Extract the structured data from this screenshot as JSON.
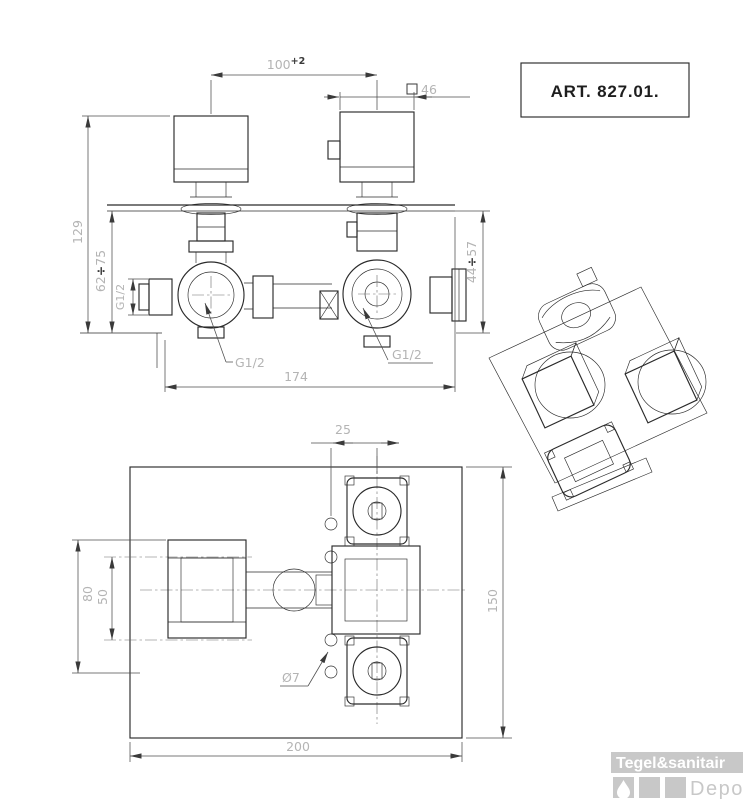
{
  "art_box": {
    "label": "ART. 827.01."
  },
  "front_view": {
    "dim_handle_spacing": {
      "value": "100",
      "tolerance": "+2"
    },
    "dim_handle_square": {
      "value": "46"
    },
    "dim_height_overall": "129",
    "dim_depth_range_left": {
      "min": "62",
      "separator": "÷",
      "max": "75"
    },
    "dim_depth_range_right": {
      "min": "44",
      "separator": "÷",
      "max": "57"
    },
    "dim_inlet_thread": "G1/2",
    "outlet_label_left": "G1/2",
    "outlet_label_right": "G1/2",
    "dim_body_width": "174"
  },
  "plan_view": {
    "dim_hole_offset": "25",
    "dim_bracket_height": "80",
    "dim_hole_spacing": "50",
    "dim_recess_height": "150",
    "dim_recess_width": "200",
    "hole_label": "Ø7"
  },
  "logo": {
    "brand": "Tegel&sanitair",
    "suffix": "Depot"
  },
  "colors": {
    "outline": "#2b2b2b",
    "dim_text": "#b4b4b4",
    "dark_accent": "#3a3a3a",
    "logo_gray": "#c8c8c8"
  }
}
